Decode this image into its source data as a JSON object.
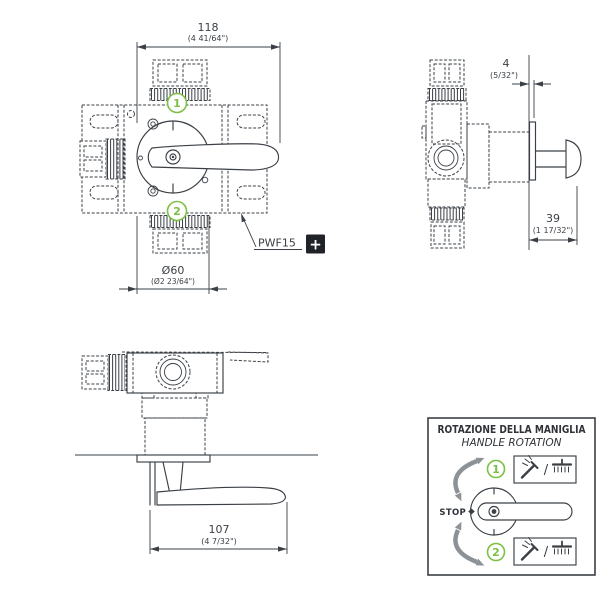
{
  "document_type": "faucet-valve technical installation drawing",
  "colors": {
    "line": "#3b4046",
    "green_accent": "#7cc043",
    "gray_arrow": "#8d9296",
    "plus_badge_bg": "#1f2226"
  },
  "front_view": {
    "dim_width_mm": "118",
    "dim_width_in": "(4 41/64\")",
    "dim_dia_mm": "Ø60",
    "dim_dia_in": "(Ø2 23/64\")",
    "outlet_top": "1",
    "outlet_bottom": "2",
    "part_code": "PWF15",
    "plus_badge": "+"
  },
  "side_view": {
    "dim_wall_gap_mm": "4",
    "dim_wall_gap_in": "(5/32\")",
    "dim_projection_mm": "39",
    "dim_projection_in": "(1 17/32\")"
  },
  "top_view": {
    "dim_handle_mm": "107",
    "dim_handle_in": "(4 7/32\")"
  },
  "rotation_box": {
    "title_it": "ROTAZIONE DELLA MANIGLIA",
    "title_en": "HANDLE ROTATION",
    "stop_label": "STOP",
    "position_1": "1",
    "position_2": "2",
    "separator": "/",
    "icons": {
      "position_1": [
        "handshower",
        "rain-shower"
      ],
      "position_2": [
        "handshower",
        "rain-shower"
      ]
    }
  }
}
